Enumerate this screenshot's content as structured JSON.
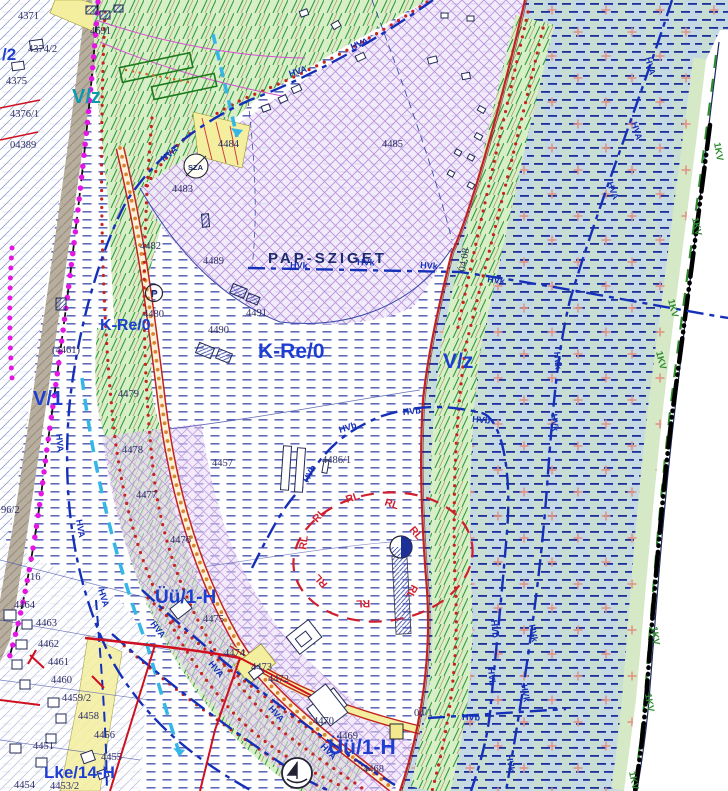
{
  "map": {
    "place_labels": [
      {
        "t": "PAP-SZIGET",
        "x": 268,
        "y": 263,
        "s": 15
      }
    ],
    "zone_labels": [
      {
        "t": "/2",
        "x": 2,
        "y": 60,
        "s": 17,
        "c": "#1e3ed2"
      },
      {
        "t": "V/z",
        "x": 72,
        "y": 103,
        "s": 20,
        "c": "#0d98ac"
      },
      {
        "t": "K-Re/0",
        "x": 100,
        "y": 330,
        "s": 16,
        "c": "#1e3ed2"
      },
      {
        "t": "K-Re/0",
        "x": 258,
        "y": 358,
        "s": 21,
        "c": "#1e3ed2"
      },
      {
        "t": "V/1",
        "x": 33,
        "y": 405,
        "s": 20,
        "c": "#1e3ed2"
      },
      {
        "t": "V/z",
        "x": 443,
        "y": 368,
        "s": 21,
        "c": "#1e3ed2"
      },
      {
        "t": "Üü/1-H",
        "x": 155,
        "y": 603,
        "s": 19,
        "c": "#1e3ed2"
      },
      {
        "t": "Üü/1-H",
        "x": 328,
        "y": 754,
        "s": 21,
        "c": "#1e3ed2"
      },
      {
        "t": "Lke/14-H",
        "x": 44,
        "y": 778,
        "s": 17,
        "c": "#1e3ed2"
      }
    ],
    "parcel_labels": [
      {
        "t": "4371",
        "x": 18,
        "y": 19
      },
      {
        "t": "4374/2",
        "x": 28,
        "y": 52
      },
      {
        "t": "4375",
        "x": 6,
        "y": 84
      },
      {
        "t": "4376/1",
        "x": 10,
        "y": 117
      },
      {
        "t": "04389",
        "x": 10,
        "y": 148
      },
      {
        "t": "4691",
        "x": 90,
        "y": 34
      },
      {
        "t": "4484",
        "x": 218,
        "y": 147
      },
      {
        "t": "4483",
        "x": 172,
        "y": 192
      },
      {
        "t": "4485",
        "x": 382,
        "y": 147
      },
      {
        "t": "4482",
        "x": 140,
        "y": 249
      },
      {
        "t": "4489",
        "x": 203,
        "y": 264
      },
      {
        "t": "4480",
        "x": 143,
        "y": 317
      },
      {
        "t": "4491",
        "x": 246,
        "y": 316
      },
      {
        "t": "4490",
        "x": 208,
        "y": 333
      },
      {
        "t": "(4461)",
        "x": 52,
        "y": 353
      },
      {
        "t": "4479",
        "x": 118,
        "y": 397
      },
      {
        "t": "4478",
        "x": 122,
        "y": 453
      },
      {
        "t": "4477",
        "x": 136,
        "y": 498
      },
      {
        "t": "4476",
        "x": 170,
        "y": 543
      },
      {
        "t": "4457",
        "x": 212,
        "y": 466
      },
      {
        "t": "4486/1",
        "x": 322,
        "y": 463
      },
      {
        "t": "4475",
        "x": 203,
        "y": 622
      },
      {
        "t": "4474",
        "x": 224,
        "y": 656
      },
      {
        "t": "4473",
        "x": 251,
        "y": 670
      },
      {
        "t": "4472",
        "x": 268,
        "y": 682
      },
      {
        "t": "4470",
        "x": 313,
        "y": 724
      },
      {
        "t": "4469",
        "x": 337,
        "y": 739
      },
      {
        "t": "4468",
        "x": 363,
        "y": 772
      },
      {
        "t": "4464",
        "x": 14,
        "y": 608
      },
      {
        "t": "4463",
        "x": 36,
        "y": 626
      },
      {
        "t": "4462",
        "x": 38,
        "y": 647
      },
      {
        "t": "4461",
        "x": 48,
        "y": 665
      },
      {
        "t": "4460",
        "x": 51,
        "y": 683
      },
      {
        "t": "4459/2",
        "x": 62,
        "y": 701
      },
      {
        "t": "4458",
        "x": 78,
        "y": 719
      },
      {
        "t": "4456",
        "x": 94,
        "y": 738
      },
      {
        "t": "4455",
        "x": 101,
        "y": 760
      },
      {
        "t": "4451",
        "x": 33,
        "y": 749
      },
      {
        "t": "4454",
        "x": 14,
        "y": 788
      },
      {
        "t": "4453/2",
        "x": 50,
        "y": 789
      },
      {
        "t": "96/2",
        "x": 1,
        "y": 513
      },
      {
        "t": "16",
        "x": 30,
        "y": 580
      },
      {
        "t": "04.08",
        "x": 465,
        "y": 272,
        "r": -80
      },
      {
        "t": "04/1",
        "x": 414,
        "y": 716
      }
    ],
    "utility_line_labels": [
      {
        "t": "HVA",
        "x": 352,
        "y": 50,
        "r": -22
      },
      {
        "t": "HVA",
        "x": 290,
        "y": 77,
        "r": -18
      },
      {
        "t": "HVA",
        "x": 164,
        "y": 162,
        "r": -40
      },
      {
        "t": "HVA",
        "x": 645,
        "y": 58,
        "r": 75
      },
      {
        "t": "HVA",
        "x": 631,
        "y": 123,
        "r": 72
      },
      {
        "t": "HVA",
        "x": 607,
        "y": 183,
        "r": 70
      },
      {
        "t": "HVA",
        "x": 56,
        "y": 434,
        "r": 85
      },
      {
        "t": "HVA",
        "x": 76,
        "y": 520,
        "r": 80
      },
      {
        "t": "HVA",
        "x": 98,
        "y": 590,
        "r": 72
      },
      {
        "t": "HVA",
        "x": 150,
        "y": 624,
        "r": 52
      },
      {
        "t": "HVA",
        "x": 208,
        "y": 664,
        "r": 50
      },
      {
        "t": "HVA",
        "x": 268,
        "y": 709,
        "r": 48
      },
      {
        "t": "HVA",
        "x": 320,
        "y": 747,
        "r": 46
      },
      {
        "t": "HVk",
        "x": 290,
        "y": 268,
        "r": 2
      },
      {
        "t": "HVk",
        "x": 357,
        "y": 265,
        "r": 2
      },
      {
        "t": "HVk",
        "x": 420,
        "y": 268,
        "r": 4
      },
      {
        "t": "HVk",
        "x": 487,
        "y": 282,
        "r": 8
      },
      {
        "t": "HVk",
        "x": 554,
        "y": 352,
        "r": 85
      },
      {
        "t": "HVk",
        "x": 551,
        "y": 414,
        "r": 85
      },
      {
        "t": "HVk",
        "x": 529,
        "y": 625,
        "r": 80
      },
      {
        "t": "HVk",
        "x": 521,
        "y": 685,
        "r": 80
      },
      {
        "t": "HVk",
        "x": 506,
        "y": 755,
        "r": 80
      },
      {
        "t": "HVb",
        "x": 340,
        "y": 433,
        "r": -18
      },
      {
        "t": "HVb",
        "x": 403,
        "y": 415,
        "r": -5
      },
      {
        "t": "HVb",
        "x": 472,
        "y": 422,
        "r": 5
      },
      {
        "t": "HVb",
        "x": 308,
        "y": 483,
        "r": -62
      },
      {
        "t": "HVb",
        "x": 491,
        "y": 620,
        "r": 85
      },
      {
        "t": "HVb",
        "x": 488,
        "y": 668,
        "r": 85
      },
      {
        "t": "HVb",
        "x": 462,
        "y": 720,
        "r": 2
      }
    ],
    "boundary_labels": [
      {
        "t": "1KV",
        "x": 714,
        "y": 143,
        "r": 80
      },
      {
        "t": "1KV",
        "x": 692,
        "y": 218,
        "r": 78
      },
      {
        "t": "1KV",
        "x": 668,
        "y": 300,
        "r": 76
      },
      {
        "t": "1KV",
        "x": 656,
        "y": 352,
        "r": 76
      },
      {
        "t": "1KV",
        "x": 651,
        "y": 627,
        "r": 82
      },
      {
        "t": "1KV",
        "x": 645,
        "y": 694,
        "r": 80
      },
      {
        "t": "1KV",
        "x": 629,
        "y": 772,
        "r": 78
      }
    ],
    "protection_labels": [
      {
        "t": "RL",
        "x": 347,
        "y": 503,
        "r": -18
      },
      {
        "t": "RL",
        "x": 384,
        "y": 505,
        "r": 18
      },
      {
        "t": "RL",
        "x": 317,
        "y": 523,
        "r": -48
      },
      {
        "t": "RL",
        "x": 409,
        "y": 530,
        "r": 50
      },
      {
        "t": "RL",
        "x": 306,
        "y": 550,
        "r": -82
      },
      {
        "t": "RL",
        "x": 412,
        "y": 584,
        "r": 118
      },
      {
        "t": "RL",
        "x": 328,
        "y": 584,
        "r": -132
      },
      {
        "t": "RL",
        "x": 370,
        "y": 600,
        "r": 178
      }
    ],
    "symbol_labels": [
      {
        "t": "SZA",
        "x": 188,
        "y": 170,
        "s": 7.5
      },
      {
        "t": "P",
        "x": 151,
        "y": 297,
        "s": 10
      }
    ],
    "colors": {
      "water_bg": "#c4d9e3",
      "water_dash": "#1d2f98",
      "cross": "#e09585",
      "green_hatch": "#2f9e3f",
      "green_bg": "#d8eec6",
      "purple_hatch": "#bb92dd",
      "zone_blue": "#1e3ed2",
      "zone_teal": "#0d98ac",
      "utility_blue": "#1530b8",
      "protection_red": "#d02030",
      "boundary_green": "#2e8b2e",
      "road_red": "#c22222",
      "orange_dots": "#d9862e",
      "magenta_dots": "#e316e3",
      "cyan_line": "#35b6e8",
      "yellow_road": "#f4ef9f"
    }
  }
}
